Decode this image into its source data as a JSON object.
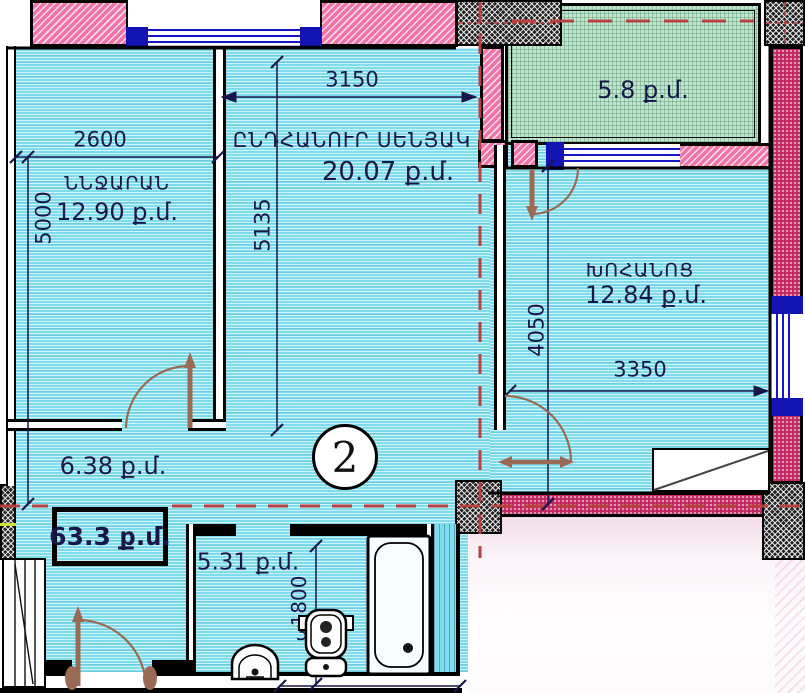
{
  "plan": {
    "unit_number": "2",
    "total_area": "63.3 ք.մ.",
    "rooms": {
      "bedroom": {
        "name": "ՆՆՋԱՐԱՆ",
        "area": "12.90 ք.մ.",
        "width_mm": "2600",
        "height_mm": "5000"
      },
      "living": {
        "name": "ԸՆԴՀԱՆՈՒՐ ՍԵՆՅԱԿ",
        "area": "20.07 ք.մ.",
        "width_mm": "3150",
        "height_mm": "5135"
      },
      "kitchen": {
        "name": "ԽՈՀԱՆՈՑ",
        "area": "12.84 ք.մ.",
        "width_mm": "3350",
        "height_mm": "4050"
      },
      "balcony": {
        "area": "5.8 ք.մ."
      },
      "hall": {
        "area": "6.38 ք.մ."
      },
      "bathroom": {
        "area": "5.31 ք.մ.",
        "width_mm": "1800",
        "depth_mm": "3900"
      }
    },
    "colors": {
      "room_fill": "#7edded",
      "balcony_fill": "#bce7cd",
      "wall_pink": "#f173a7",
      "wall_magenta": "#c32561",
      "axis_red": "#b94040",
      "door_brown": "#9a6a55",
      "window_blue": "#1717c9",
      "ink": "#16164a"
    }
  }
}
